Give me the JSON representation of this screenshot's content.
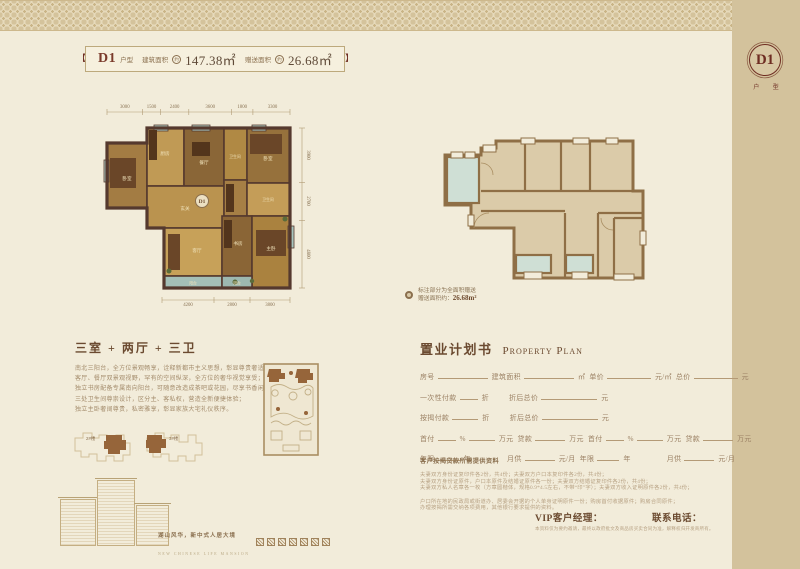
{
  "colors": {
    "page_bg": "#f2ecda",
    "side_band": "#d3c29c",
    "maroon": "#7a3a2b",
    "title_brown": "#6b4a30",
    "body_text": "#a48c6c",
    "wall_dark": "#55392e",
    "wall_line": "#8f6f46",
    "plan_fill": "#dbcba9",
    "gift_teal": "#cfdfd5"
  },
  "header": {
    "unit": "D1",
    "unit_suffix": "户型",
    "area_label": "建筑面积",
    "approx": "约",
    "area_value": "147.38㎡",
    "gift_label": "赠送面积",
    "gift_value": "26.68㎡"
  },
  "side_band": {
    "badge": "D1",
    "badge_sub": "户 型",
    "vertical_text": "三室 + 两厅 + 三卫"
  },
  "left_plan": {
    "badge": "D1",
    "dims_top": [
      "3000",
      "1500",
      "2400",
      "3600",
      "1800",
      "3300"
    ],
    "dims_right": [
      "3900",
      "2700",
      "4800"
    ],
    "dims_bottom": [
      "4200",
      "2800",
      "3800"
    ],
    "rooms": [
      "卧室",
      "厨房",
      "餐厅",
      "卫生间",
      "卧室",
      "玄关",
      "客厅",
      "书房",
      "卫生间",
      "主卧",
      "阳台",
      "阳台"
    ]
  },
  "right_plan": {
    "note_line1": "标注部分为全面积赠送",
    "note_label": "赠送面积约：",
    "note_value": "26.68m²"
  },
  "description": {
    "title": "三室 + 两厅 + 三卫",
    "lines": [
      "南北三阳台，全方位景观畅享，诠释新都市主义思想，彰显尊贵奢适；",
      "客厅、餐厅双景观视野，罕有的空间纵深，全方位的奢华视觉享受；",
      "独立书房配备专属南向阳台，可随意改造成茶吧或花园，尽享书香闲逸心情；",
      "三处卫生间尊崇设计，区分主、客私权，营造全新便捷体验；",
      "独立主卧奢阔尊贵，私密雅享，彰显家族大宅礼仪秩序。"
    ]
  },
  "site": {
    "building_a": "2#楼",
    "building_b": "3#楼"
  },
  "branding": {
    "slogan_cn": "湖山风华，新中式人居大境",
    "slogan_en": "NEW CHINESE LIFE MANSION",
    "seal_count": 7
  },
  "property_plan": {
    "title_cn": "置业计划书",
    "title_en": "Property Plan",
    "labels": {
      "room_no": "房号",
      "area": "建筑面积",
      "sqm": "㎡",
      "unit_price": "单价",
      "yuan_per_sqm": "元/㎡",
      "total_price": "总价",
      "yuan": "元",
      "one_time": "一次性付款",
      "discount": "折",
      "discounted_total": "折后总价",
      "mortgage": "按揭付款",
      "down_payment": "首付",
      "percent": "%",
      "wan": "万元",
      "loan": "贷款",
      "years": "年限",
      "year": "年",
      "monthly": "月供",
      "yuan_per_month": "元/月"
    }
  },
  "mortgage_docs": {
    "heading": "客户按揭贷款所需提供资料",
    "lines": [
      "夫妻双方身份证复印件各2份，共4份；夫妻双方户口本复印件各2份，共4份；",
      "夫妻双方身份证原件，户口本原件及结婚证原件各一份；夫妻双方结婚证复印件各2份，共4份；",
      "夫妻双方私人名章各一枚（方章圆楷体，规格0.9*4.5左右，不带“印”字）；夫妻双方收入证明原件各2份，共4份；",
      "户口所在地的民政局或街道办、居委会开据的个人单身证明原件一份；购房首付收据原件；购房合同原件；",
      "办理按揭所需交纳各项费用，其他银行要求提供的资料。"
    ]
  },
  "vip": {
    "manager_label": "VIP客户经理：",
    "phone_label": "联系电话：",
    "disclaimer": "本资料仅为要约邀请，最终以政府批文及商品房买卖合同为准，解释权归开发商所有。"
  }
}
